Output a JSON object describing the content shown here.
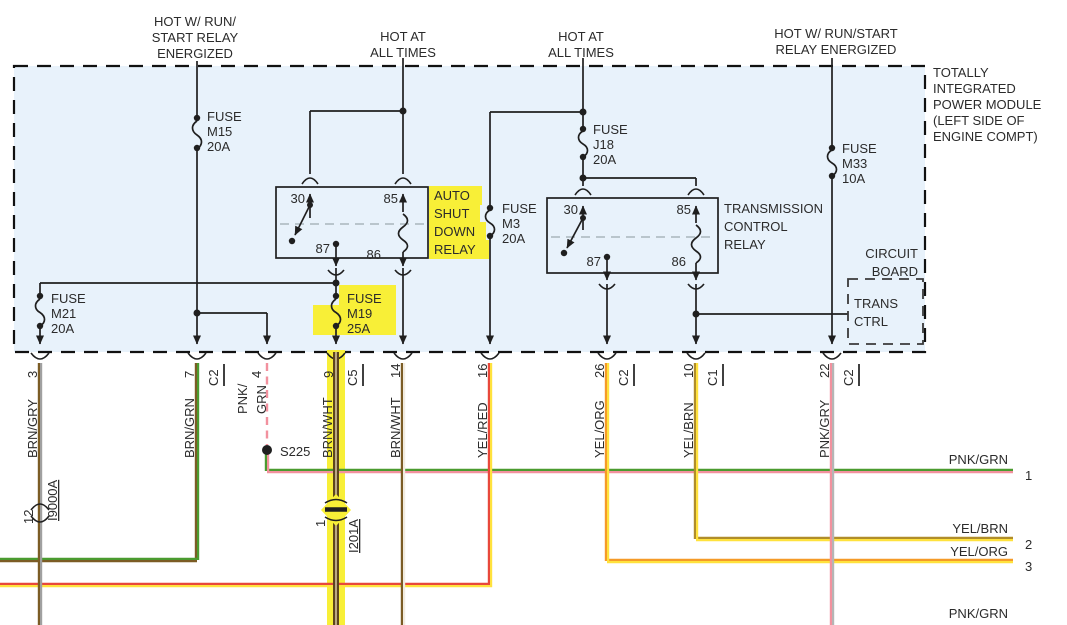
{
  "colors": {
    "module_fill": "#e8f2fb",
    "highlight": "#f8ef37",
    "wire_brown": "#7b5c25",
    "wire_gray": "#a0a0a0",
    "wire_green": "#4a9b2f",
    "wire_pink": "#f2919e",
    "wire_yellow": "#ffe23d",
    "wire_red": "#e8483b",
    "wire_orange": "#f59a28",
    "thick_wire_core": "#5c451d"
  },
  "feeds": [
    {
      "lines": [
        "HOT W/ RUN/",
        "START RELAY",
        "ENERGIZED"
      ]
    },
    {
      "lines": [
        "HOT AT",
        "ALL TIMES"
      ]
    },
    {
      "lines": [
        "HOT AT",
        "ALL TIMES"
      ]
    },
    {
      "lines": [
        "HOT W/ RUN/START",
        "RELAY ENERGIZED"
      ]
    }
  ],
  "module": {
    "label_lines": [
      "TOTALLY",
      "INTEGRATED",
      "POWER MODULE",
      "(LEFT SIDE OF",
      "ENGINE COMPT)"
    ],
    "circuit_board_lines": [
      "CIRCUIT",
      "BOARD"
    ],
    "trans_ctrl_lines": [
      "TRANS",
      "CTRL"
    ]
  },
  "fuses": {
    "m15": {
      "name": "FUSE",
      "id": "M15",
      "amps": "20A"
    },
    "j18": {
      "name": "FUSE",
      "id": "J18",
      "amps": "20A"
    },
    "m33": {
      "name": "FUSE",
      "id": "M33",
      "amps": "10A"
    },
    "m3": {
      "name": "FUSE",
      "id": "M3",
      "amps": "20A"
    },
    "m21": {
      "name": "FUSE",
      "id": "M21",
      "amps": "20A"
    },
    "m19": {
      "name": "FUSE",
      "id": "M19",
      "amps": "25A"
    }
  },
  "relays": {
    "asd": {
      "label_lines": [
        "AUTO",
        "SHUT",
        "DOWN",
        "RELAY"
      ],
      "pins": {
        "p30": "30",
        "p85": "85",
        "p87": "87",
        "p86": "86"
      }
    },
    "tcr": {
      "label_lines": [
        "TRANSMISSION",
        "CONTROL",
        "RELAY"
      ],
      "pins": {
        "p30": "30",
        "p85": "85",
        "p87": "87",
        "p86": "86"
      }
    }
  },
  "pins": [
    {
      "num": "3",
      "wire": "BRN/GRY"
    },
    {
      "num": "7",
      "conn": "C2",
      "wire": "BRN/GRN"
    },
    {
      "num": "4",
      "wire_lines": [
        "PNK/",
        "GRN"
      ]
    },
    {
      "num": "9",
      "conn": "C5",
      "wire": "BRN/WHT"
    },
    {
      "num": "14",
      "wire": "BRN/WHT"
    },
    {
      "num": "16",
      "wire": "YEL/RED"
    },
    {
      "num": "26",
      "conn": "C2",
      "wire": "YEL/ORG"
    },
    {
      "num": "10",
      "conn": "C1",
      "wire": "YEL/BRN"
    },
    {
      "num": "22",
      "conn": "C2",
      "wire": "PNK/GRY"
    }
  ],
  "splice": {
    "id": "S225"
  },
  "inline_connectors": [
    {
      "pin": "12",
      "id": "I9000A"
    },
    {
      "pin": "1",
      "id": "I201A"
    }
  ],
  "right_wires": [
    {
      "label": "PNK/GRN",
      "num": "1"
    },
    {
      "label": "YEL/BRN",
      "num": "2"
    },
    {
      "label": "YEL/ORG",
      "num": "3"
    },
    {
      "label": "PNK/GRN",
      "num": ""
    }
  ]
}
